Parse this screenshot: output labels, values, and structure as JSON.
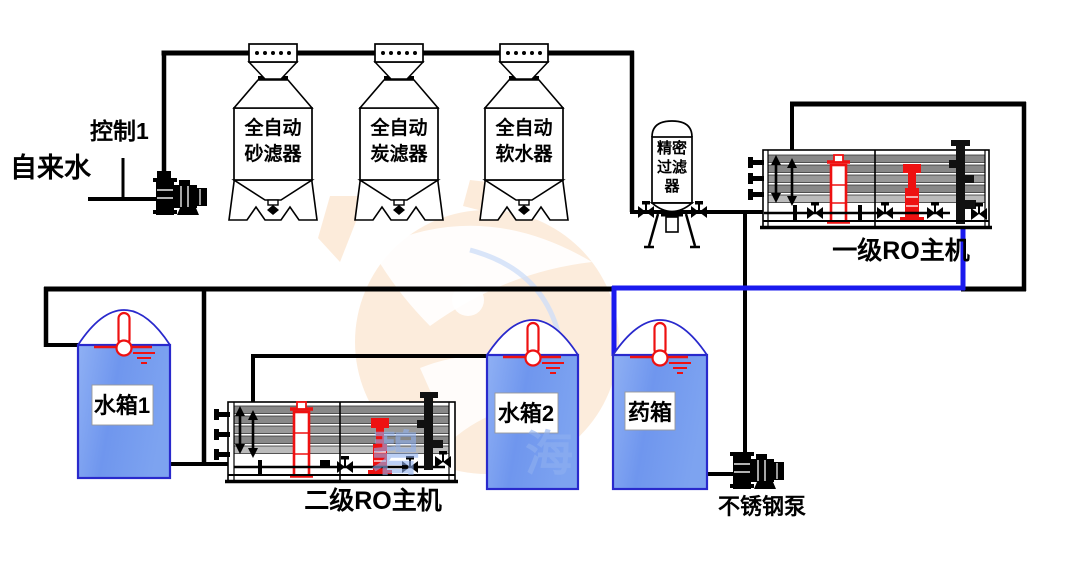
{
  "diagram_type": "water-treatment-process-flow",
  "colors": {
    "pipe_black": "#000000",
    "pipe_blue": "#1a1aee",
    "tank_border": "#2929cc",
    "tank_fill_light": "#8fb0f4",
    "tank_fill_dark": "#6f96ee",
    "equipment_red": "#ee1111",
    "membrane_gray": "#8f8f8f",
    "watermark_orange": "#fbe7d3",
    "watermark_blue": "#8fb0f0"
  },
  "source": {
    "control_label": "控制1",
    "feed_label": "自来水"
  },
  "pretreatment": {
    "filters": [
      {
        "label_line1": "全自动",
        "label_line2": "砂滤器"
      },
      {
        "label_line1": "全自动",
        "label_line2": "炭滤器"
      },
      {
        "label_line1": "全自动",
        "label_line2": "软水器"
      }
    ],
    "precision_filter": {
      "label_line1": "精密",
      "label_line2": "过滤",
      "label_line3": "器"
    }
  },
  "ro_units": {
    "stage1": {
      "label": "一级RO主机"
    },
    "stage2": {
      "label": "二级RO主机"
    }
  },
  "tanks": {
    "tank1": {
      "label": "水箱1"
    },
    "tank2": {
      "label": "水箱2"
    },
    "dosing": {
      "label": "药箱"
    }
  },
  "pumps": {
    "stainless": {
      "label": "不锈钢泵"
    }
  },
  "watermark": {
    "text": "碧海"
  }
}
